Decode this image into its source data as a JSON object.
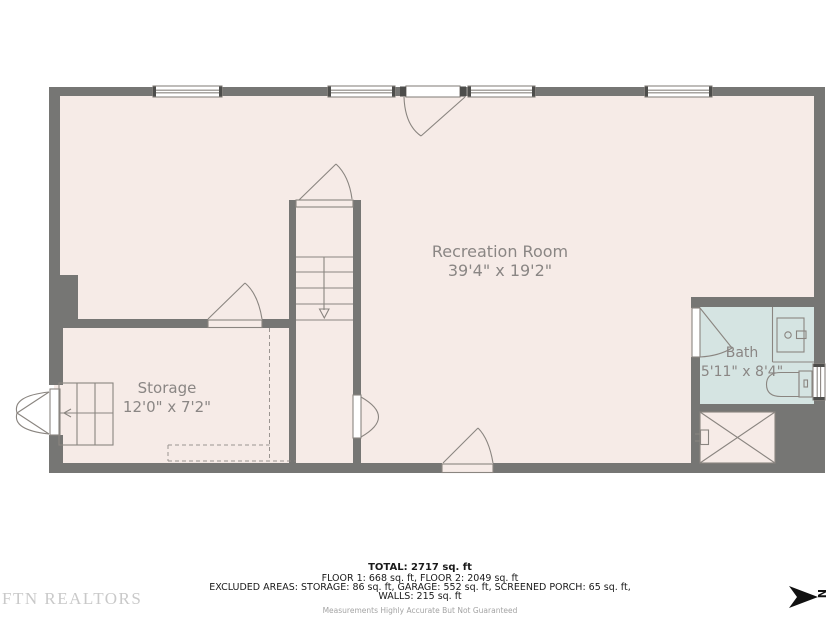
{
  "floor_plan": {
    "rooms": [
      {
        "name": "Recreation Room",
        "dimensions": "39'4\" x 19'2\""
      },
      {
        "name": "Storage",
        "dimensions": "12'0\" x 7'2\""
      },
      {
        "name": "Bath",
        "dimensions": "5'11\" x 8'4\""
      }
    ],
    "colors": {
      "wall": "#767674",
      "floor": "#f6ebe7",
      "bath_floor": "#d5e4e2",
      "line": "#8a8580",
      "label_text": "#8a8684"
    }
  },
  "summary": {
    "total": "TOTAL: 2717 sq. ft",
    "floors": "FLOOR 1: 668 sq. ft, FLOOR 2: 2049 sq. ft",
    "excluded_areas": "EXCLUDED AREAS: STORAGE: 86 sq. ft, GARAGE: 552 sq. ft, SCREENED PORCH: 65 sq. ft,",
    "walls": "WALLS: 215 sq. ft",
    "disclaimer": "Measurements Highly Accurate But Not Guaranteed"
  },
  "branding": {
    "logo_text": "FTN REALTORS"
  },
  "compass": {
    "north_label": "N"
  }
}
